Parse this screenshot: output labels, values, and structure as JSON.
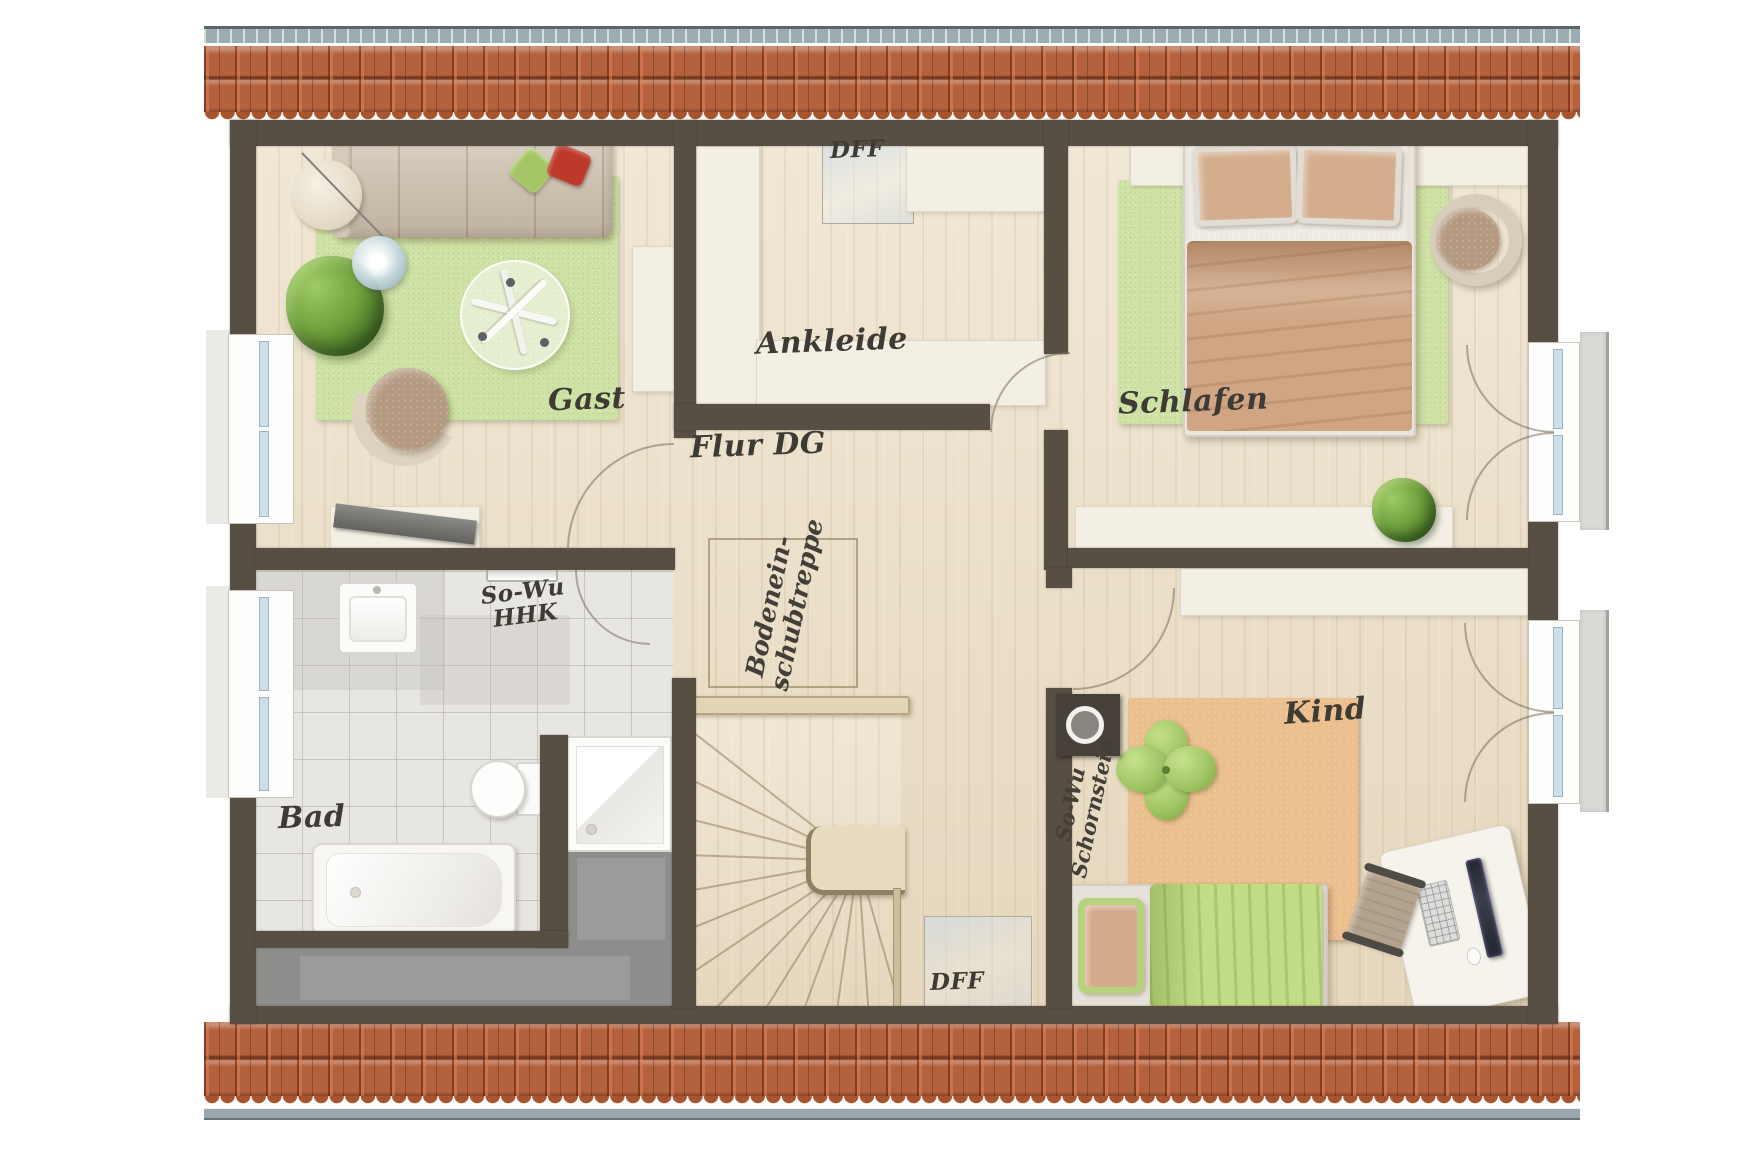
{
  "rooms": {
    "gast": {
      "label": "Gast"
    },
    "ankleide": {
      "label": "Ankleide"
    },
    "schlafen": {
      "label": "Schlafen"
    },
    "flur": {
      "label": "Flur DG"
    },
    "bad": {
      "label": "Bad"
    },
    "kind": {
      "label": "Kind"
    }
  },
  "annotations": {
    "dff_top": {
      "label": "DFF"
    },
    "dff_bottom": {
      "label": "DFF"
    },
    "attic_ladder": {
      "line1": "Bodenein-",
      "line2": "schubtreppe"
    },
    "towel_radiator": {
      "line1": "So-Wu",
      "line2": "HHK"
    },
    "chimney": {
      "line1": "So-Wu",
      "line2": "Schornstein"
    }
  },
  "palette": {
    "wall": "#574e44",
    "roof_tile": "#b4613e",
    "roof_ridge": "#9cadb2",
    "wood_floor": "#ebdfc7",
    "tile_floor": "#e8e6e2",
    "rug_green": "#cfe2a5",
    "rug_cork": "#ecbf8e",
    "storage_grey": "#8d8d8b",
    "furniture_cream": "#f3efe4",
    "bed_tan": "#cfa583",
    "kind_bed_green": "#c3dd87",
    "pillow_green": "#a6c566",
    "pillow_red": "#bd3a2a"
  }
}
